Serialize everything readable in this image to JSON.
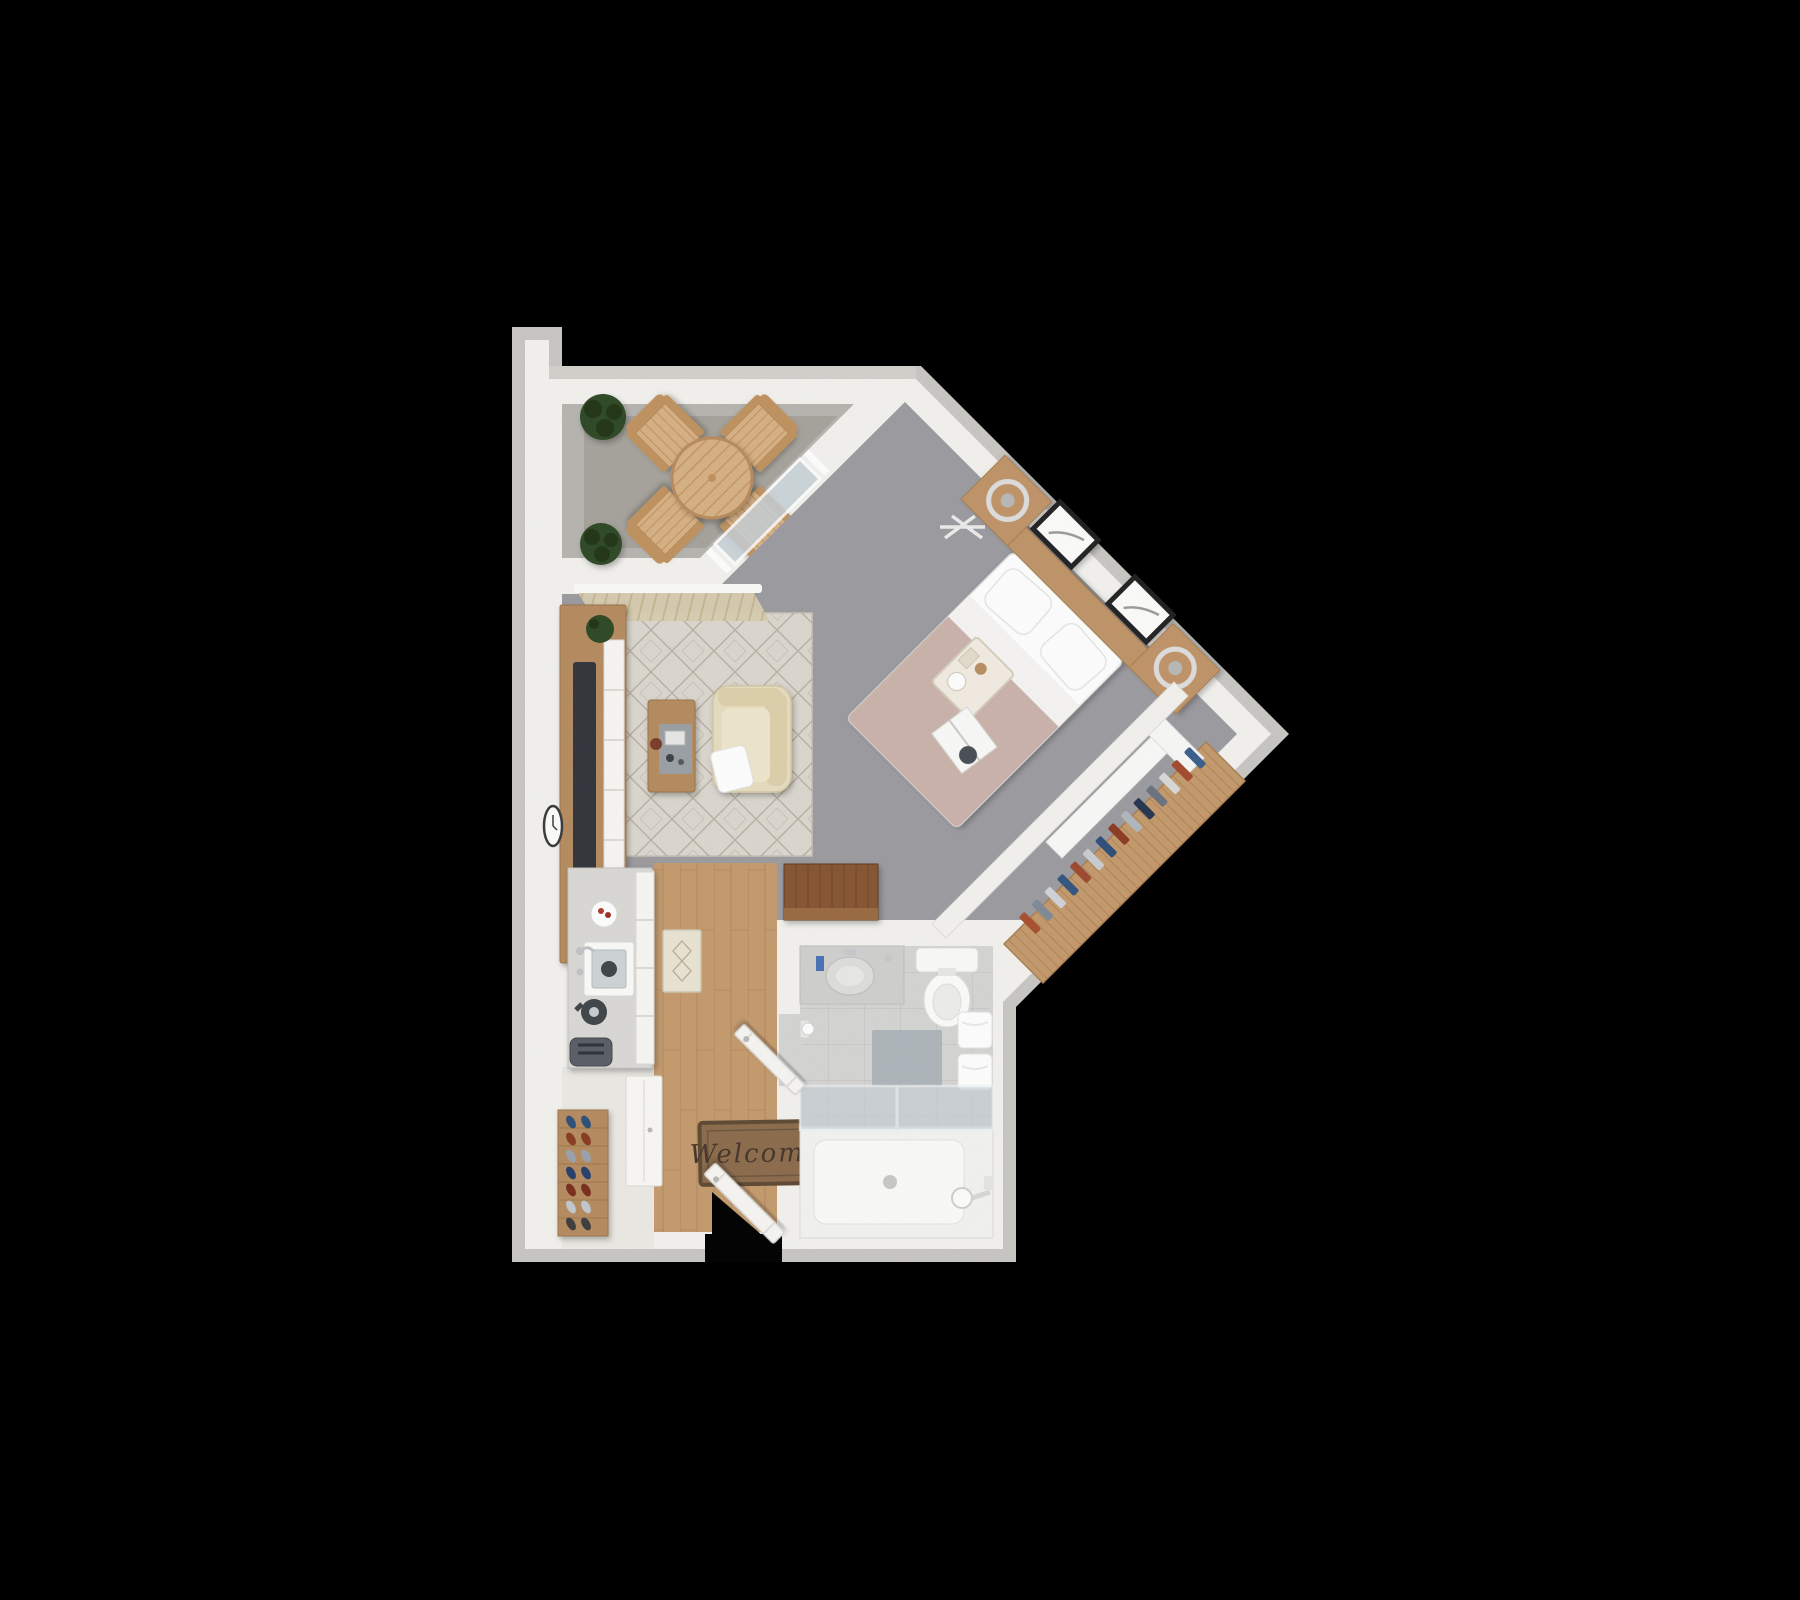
{
  "floorplan": {
    "mat_text": "Welcome"
  },
  "palette": {
    "bg": "#000000",
    "edge": "#c8c7c3",
    "wall": "#f3f2ee",
    "railing": "#d2d1cc",
    "balcony_floor": "#b7b5b0",
    "balcony_rug": "#a6a39c",
    "carpet": "#9c9ba0",
    "rug": "#dcd8d0",
    "rug_line": "#b0a798",
    "wood": "#c59b6e",
    "wood_line": "#aa8052",
    "wood_dark": "#875531",
    "wood_mid": "#b68c60",
    "outdoor_wood": "#d7b184",
    "outdoor_wood_dark": "#c0925f",
    "closet_shelf": "#c49a6c",
    "tile": "#d5d5d3",
    "tile_line": "#c3c3c1",
    "counter": "#dad9d5",
    "cabinet": "#f8f7f3",
    "duvet": "#cbb3ab",
    "headboard": "#c09467",
    "armchair": "#e7ddc0",
    "armchair_dark": "#ddd1ab",
    "mat": "#8c6c4c",
    "mat_border": "#5f4a33",
    "mat_text_color": "#46362a",
    "plant": "#2e4a26",
    "plant_dark": "#203618",
    "tub_glass": "#c6d0d6",
    "appliance_dark": "#4a4f57",
    "tv": "#33363b",
    "white": "#fbfbf9",
    "entry_floor": "#eceae4",
    "bathmat": "#aab2b8",
    "tray": "#9aa0a4"
  },
  "closet_clothes": [
    "#3a5e8c",
    "#a34b2e",
    "#d9d9d9",
    "#6b7280",
    "#24364f",
    "#b0b7bf",
    "#8c3b24",
    "#2f4f7a",
    "#c9cdd2",
    "#9c4a30",
    "#33567f",
    "#d0d4d8",
    "#7e8a96",
    "#a8502f"
  ],
  "shoes": [
    "#2e4f7a",
    "#8a3b22",
    "#9aa2ad",
    "#27406a",
    "#7a2f1d",
    "#c2c8cf",
    "#3d3d3d"
  ]
}
